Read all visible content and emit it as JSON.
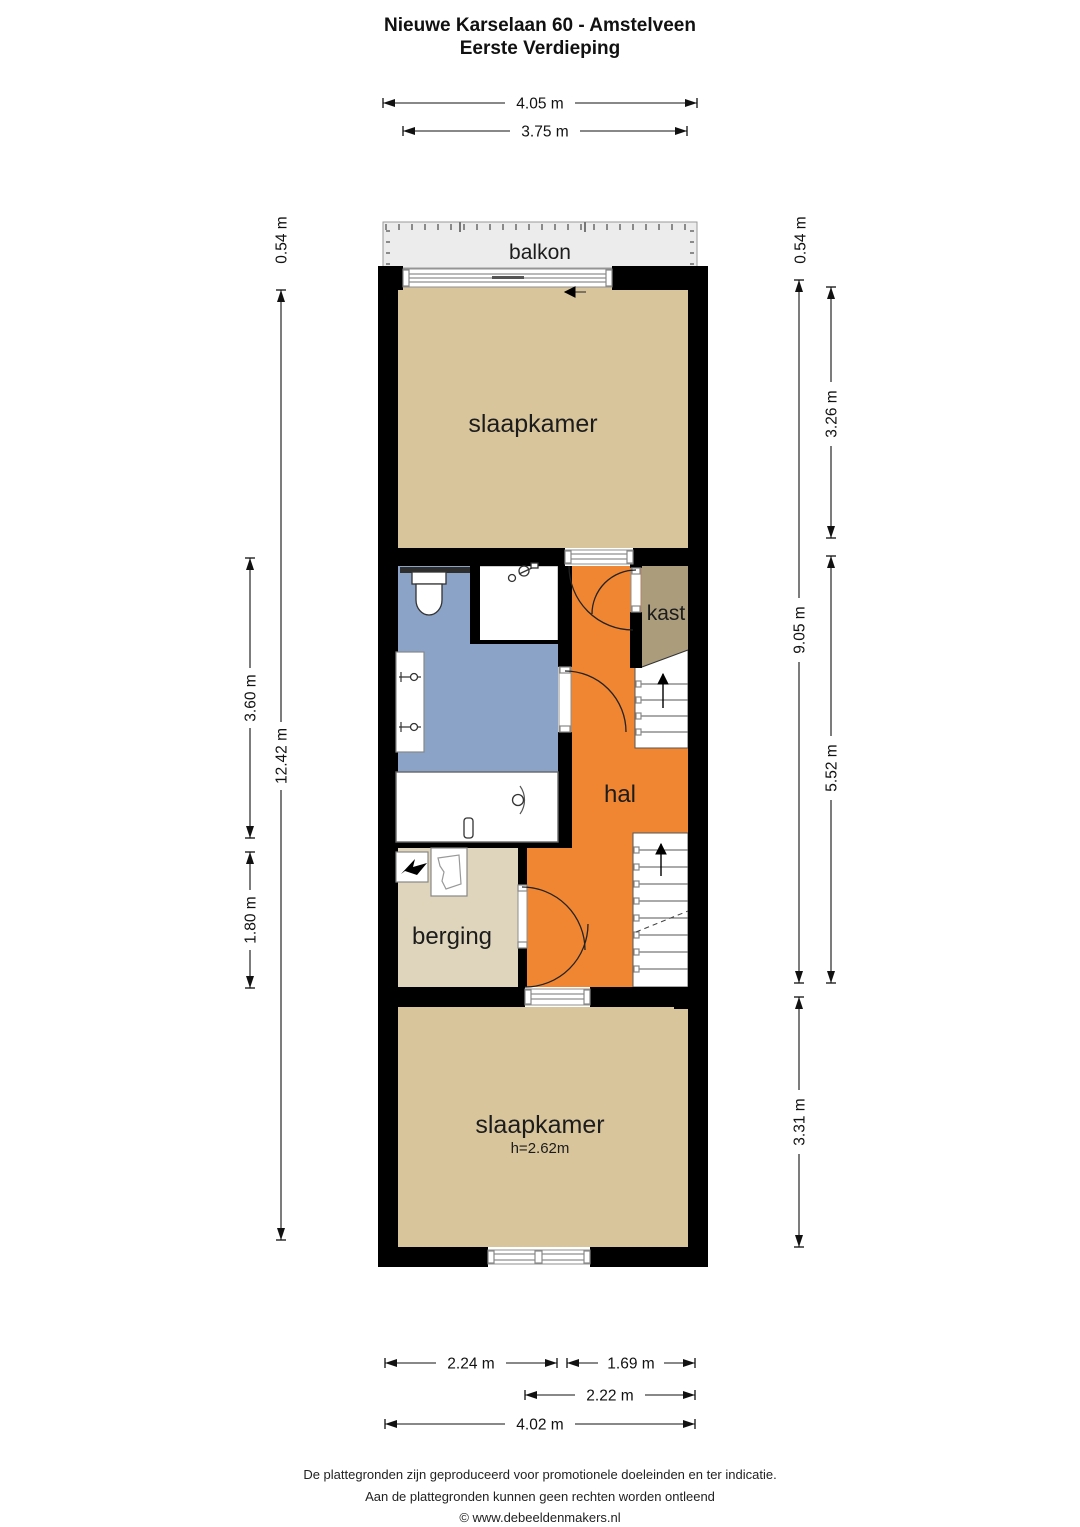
{
  "title": {
    "line1": "Nieuwe Karselaan 60 - Amstelveen",
    "line2": "Eerste Verdieping"
  },
  "rooms": {
    "balkon": "balkon",
    "slaapkamer_top": "slaapkamer",
    "kast": "kast",
    "hal": "hal",
    "berging": "berging",
    "slaapkamer_bottom": "slaapkamer",
    "slaapkamer_bottom_ceiling": "h=2.62m"
  },
  "dimensions": {
    "top": [
      "4.05 m",
      "3.75 m"
    ],
    "left": [
      "0.54 m",
      "3.60 m",
      "12.42 m",
      "1.80 m"
    ],
    "right": [
      "0.54 m",
      "3.26 m",
      "9.05 m",
      "5.52 m",
      "3.31 m"
    ],
    "bottom": [
      "2.24 m",
      "1.69 m",
      "2.22 m",
      "4.02 m"
    ]
  },
  "footer": {
    "line1": "De plattegronden zijn geproduceerd voor promotionele doeleinden en ter indicatie.",
    "line2": "Aan de plattegronden kunnen geen rechten worden ontleend",
    "line3": "© www.debeeldenmakers.nl"
  },
  "colors": {
    "wall": "#000000",
    "bedroom_tan": "#d8c59c",
    "bathroom_blue": "#8ba3c7",
    "hall_orange": "#f08632",
    "closet_taupe": "#ab9c7c",
    "storage_beige": "#ded5bc",
    "balcony_gray": "#ececec"
  }
}
